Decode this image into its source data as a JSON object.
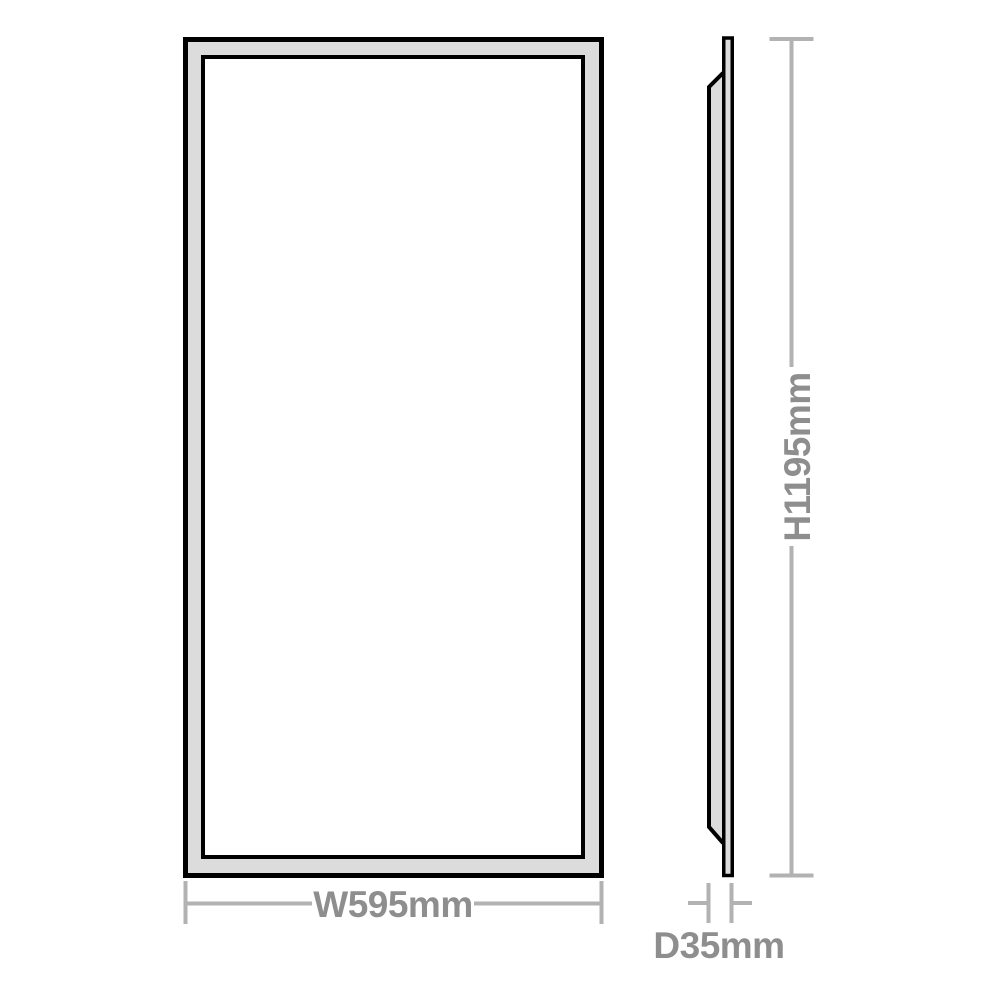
{
  "diagram": {
    "labels": {
      "width": "W595mm",
      "height": "H1195mm",
      "depth": "D35mm"
    },
    "colors": {
      "outline": "#000000",
      "frame_fill": "#dcdcdc",
      "panel_fill": "#ffffff",
      "dim_line": "#b2b2b2",
      "dim_text": "#8e8e8e",
      "background": "#ffffff"
    }
  }
}
